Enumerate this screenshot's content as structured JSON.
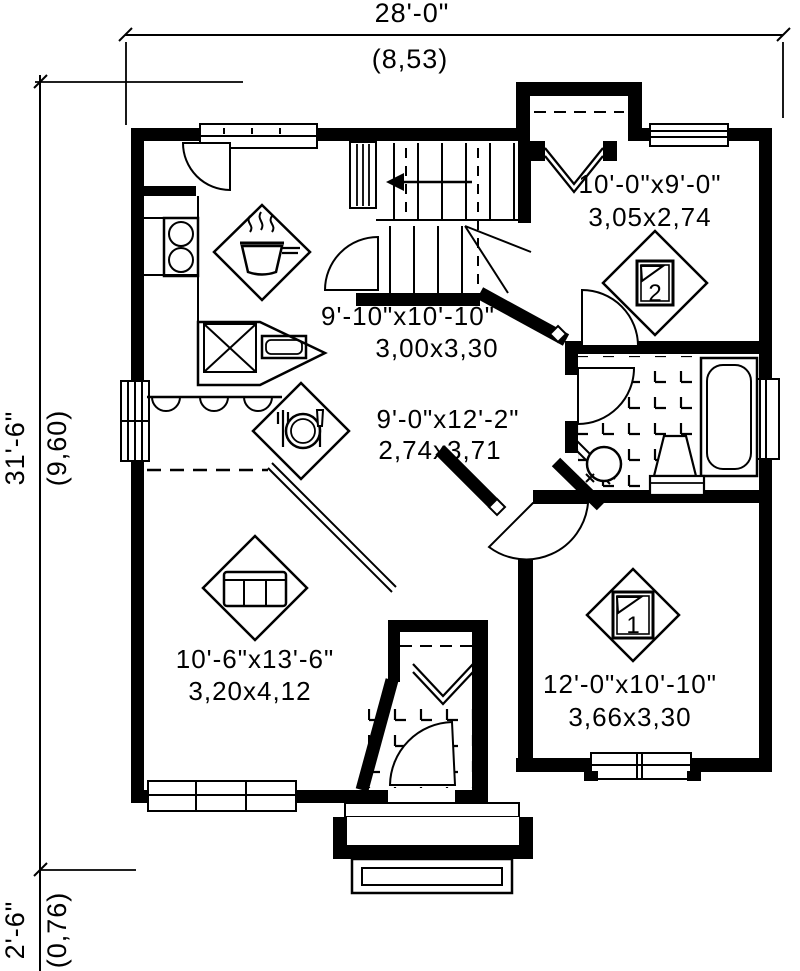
{
  "drawing": {
    "dims": {
      "top": {
        "imperial": "28'-0\"",
        "metric": "(8,53)"
      },
      "left": {
        "imperial": "31'-6\"",
        "metric": "(9,60)"
      },
      "porch": {
        "imperial": "2'-6\"",
        "metric": "(0,76)"
      }
    },
    "rooms": {
      "bedroom2": {
        "size_imperial": "10'-0\"x9'-0\"",
        "size_metric": "3,05x2,74",
        "badge": "2",
        "icon": "bed-icon"
      },
      "kitchen": {
        "size_imperial": "9'-10\"x10'-10\"",
        "size_metric": "3,00x3,30",
        "icon": "cooking-pot-icon"
      },
      "dining": {
        "size_imperial": "9'-0\"x12'-2\"",
        "size_metric": "2,74x3,71",
        "icon": "cutlery-icon"
      },
      "living": {
        "size_imperial": "10'-6\"x13'-6\"",
        "size_metric": "3,20x4,12",
        "icon": "sofa-icon"
      },
      "bedroom1": {
        "size_imperial": "12'-0\"x10'-10\"",
        "size_metric": "3,66x3,30",
        "badge": "1",
        "icon": "bed-icon"
      }
    },
    "colors": {
      "ink": "#000000",
      "paper": "#ffffff"
    }
  }
}
